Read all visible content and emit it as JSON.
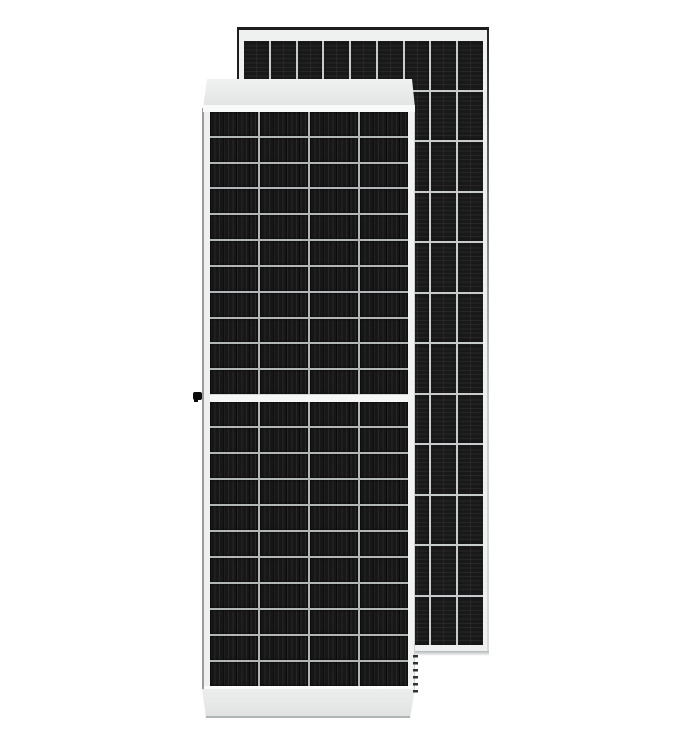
{
  "scene": {
    "background_color": "#ffffff",
    "subject": "two solar photovoltaic panels, front view overlapping rear view"
  },
  "front_panel": {
    "view": "front",
    "columns": 4,
    "rows_per_half": 11,
    "halves": 2,
    "cell_color": "#171717",
    "stripe_color": "#272727",
    "grid_line_color": "#b2b6b6",
    "center_gap_color": "#f5f7f7",
    "frame_color": "#e6e8e8"
  },
  "back_panel": {
    "view": "rear",
    "columns": 9,
    "rows": 12,
    "cell_color": "#191919",
    "stripe_color": "#262626",
    "grid_line_color": "#c7cbcb",
    "frame_color": "#eff1f1",
    "edge_color": "#1d1d1d"
  },
  "hardware": {
    "grounding_lug_color": "#0b0b0b",
    "drain_hole_color": "#333333"
  }
}
